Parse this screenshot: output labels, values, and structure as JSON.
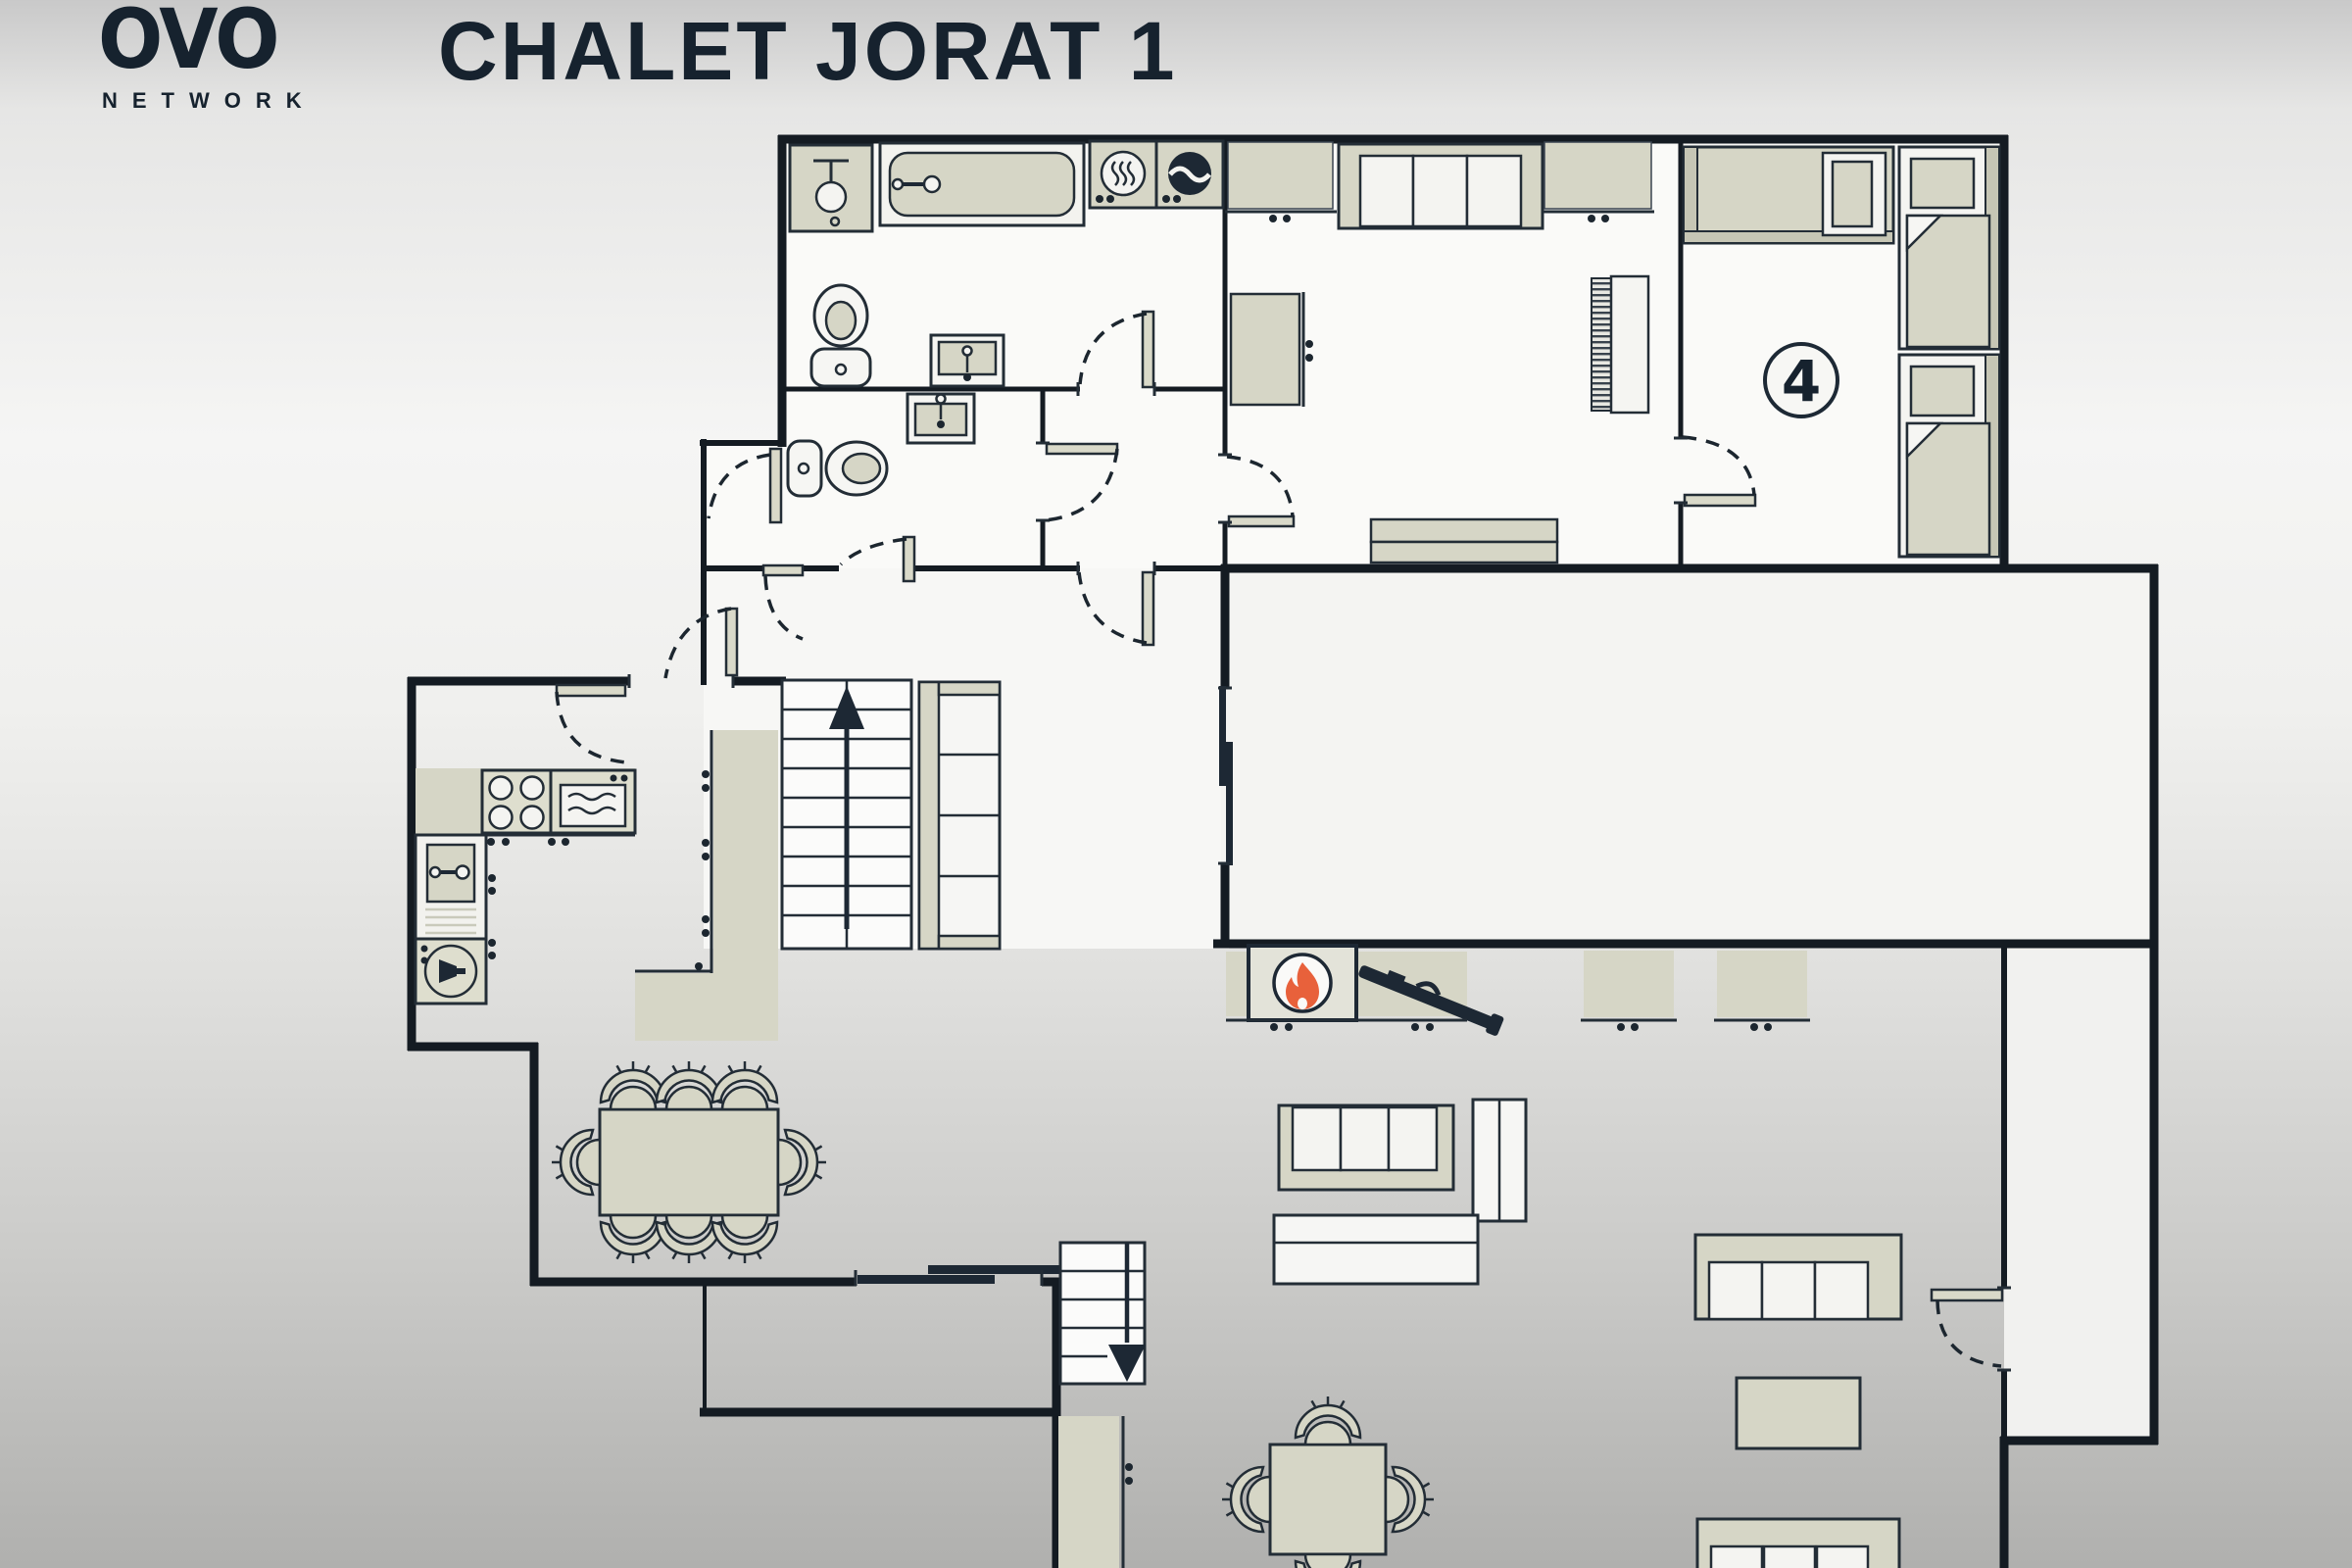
{
  "header": {
    "logo_text": "OVO",
    "logo_subtext": "NETWORK",
    "title": "CHALET JORAT 1"
  },
  "plan": {
    "bedroom_badge": "4",
    "badge_meaning": "sleeps 4"
  },
  "icons": [
    "flame-icon",
    "tv-icon",
    "washing-machine-icon",
    "tumble-dryer-icon",
    "dishwasher-icon",
    "shower-icon",
    "bathtub-icon",
    "toilet-icon",
    "sink-icon",
    "stove-icon",
    "oven-icon",
    "stairs-up-arrow-icon",
    "stairs-down-arrow-icon",
    "door-swing-arc",
    "sliding-door"
  ],
  "colors": {
    "ink": "#16222e",
    "wall": "#141b22",
    "furniture_outline": "#232d36",
    "furniture_beige": "#d6d6c6",
    "furniture_light": "#f4f4f1",
    "flame_orange": "#e8613b",
    "background_top": "#c9c9c9",
    "background_bottom": "#b0b0ae",
    "room_fill": "#fafaf8"
  }
}
